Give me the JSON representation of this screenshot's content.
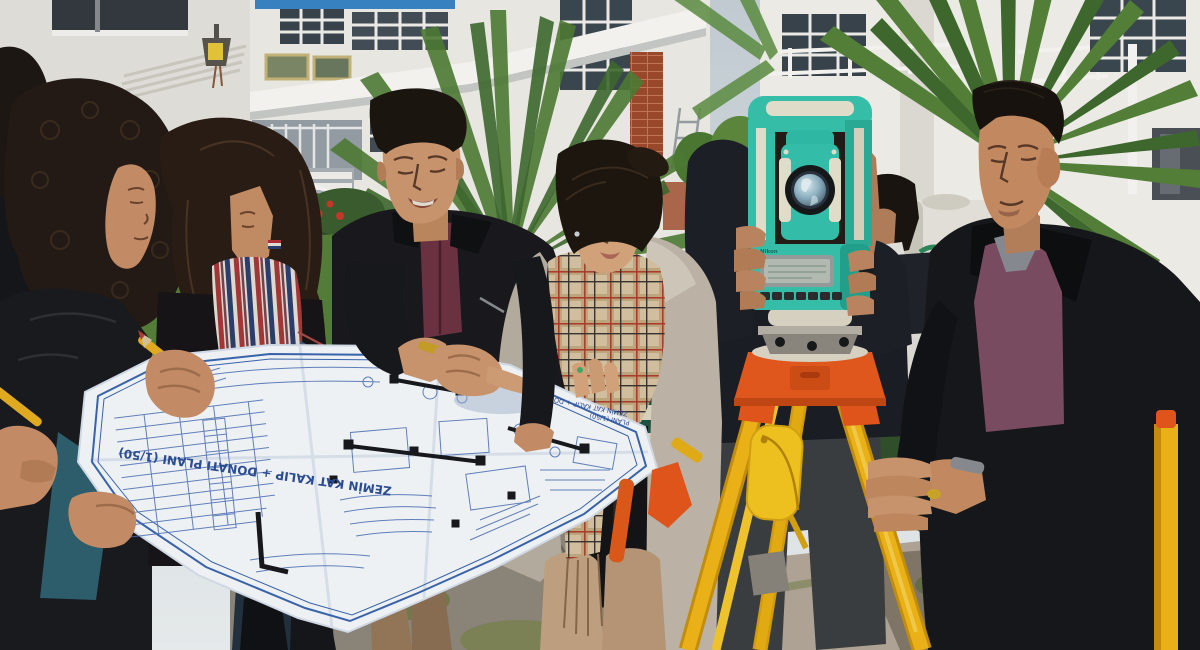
{
  "scene": {
    "description": "Outdoor photo: a group of surveying students and engineers in a courtyard of white apartment-style buildings; four people on the left study a large construction blueprint while one man looks through a teal total station mounted on a yellow-and-orange tripod and another man in a leather jacket holds the tripod leg.",
    "setting": "university courtyard with white buildings, palm trees, hedges, lawn and stone paving"
  },
  "blueprint": {
    "title": "ZEMİN KAT KALIP + DONATI PLANI (1/50)",
    "subtitle_line1": "ZEMİN KAT KALIP + DONATI",
    "subtitle_line2": "PLANI (1/50)",
    "paper_color": "#f7fafd",
    "line_color": "#4a6fb5"
  },
  "total_station": {
    "brand": "Nikon",
    "body_color": "#38c4ae",
    "accent_color": "#e9e4d2"
  },
  "tripod": {
    "leg_color": "#f2b718",
    "head_color": "#e8571c"
  },
  "water_tank": {
    "label": "PANAJA",
    "label_color": "#2e8a5c"
  },
  "palette": {
    "sky": "#cfd9de",
    "building_white": "#f1efea",
    "hedge_green": "#2f4f28",
    "lawn_green": "#527a30",
    "leather_black": "#17181c",
    "maroon_shirt": "#6e3342",
    "purple_sweater": "#7d4e63",
    "plaid_scarf": "#d6c3a2",
    "skin": "#cf9871"
  }
}
